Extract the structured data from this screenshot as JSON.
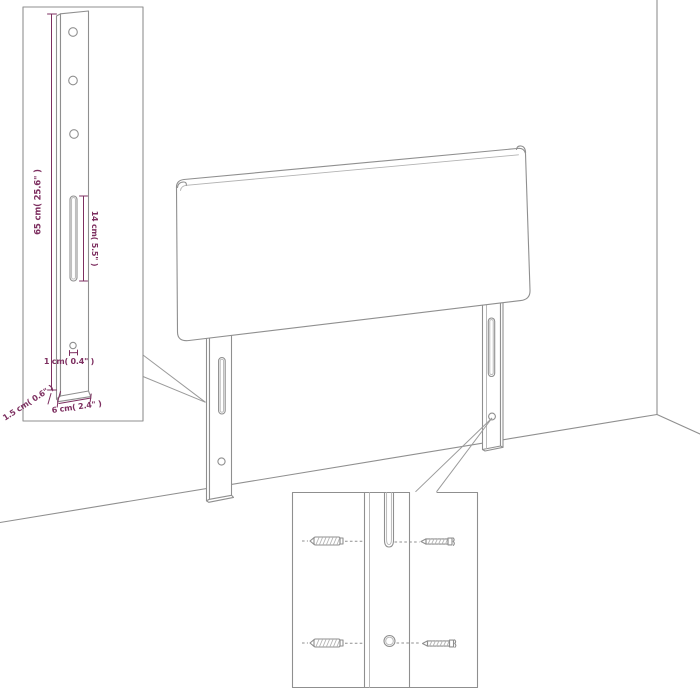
{
  "figure": {
    "background": "#ffffff",
    "line_color": "#8f8f8f",
    "dimension_color": "#7d2f60"
  },
  "leg_detail": {
    "dim_height": "65 cm( 25.6\" )",
    "dim_slot_length": "14 cm( 5.5\" )",
    "dim_hole": "1 cm( 0.4\" )",
    "dim_thickness": "1.5 cm( 0.6\" )",
    "dim_width": "6 cm( 2.4\" )"
  }
}
